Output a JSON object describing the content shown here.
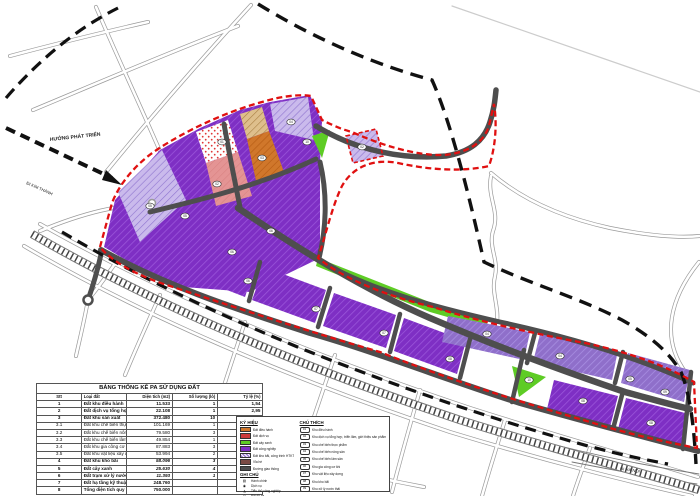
{
  "map": {
    "labels": {
      "development_direction": "HƯỚNG PHÁT TRIỂN",
      "to_kim_thanh": "ĐI KIM THÀNH",
      "to_ha_noi": "ĐI HÀ NỘI"
    },
    "colors": {
      "industrial_purple": "#7e2fc4",
      "industrial_light_purple": "#8f6fca",
      "planned_lavender": "#cabaec",
      "admin_orange": "#d0772b",
      "service_red": "#cc3b3b",
      "green_space": "#5ecc25",
      "pink_zone": "#e49494",
      "tan_zone": "#debf8c",
      "road_dark": "#4e4e4e",
      "railway_gray": "#555555",
      "boundary_red_dashed": "#e01010",
      "boundary_black_dashed": "#111111"
    },
    "parcel_markers": [
      {
        "x": 150,
        "y": 206,
        "l": "05"
      },
      {
        "x": 185,
        "y": 216,
        "l": "05"
      },
      {
        "x": 222,
        "y": 142,
        "l": "01"
      },
      {
        "x": 217,
        "y": 184,
        "l": "02"
      },
      {
        "x": 262,
        "y": 158,
        "l": "03"
      },
      {
        "x": 291,
        "y": 122,
        "l": "04"
      },
      {
        "x": 307,
        "y": 142,
        "l": "10"
      },
      {
        "x": 232,
        "y": 252,
        "l": "06"
      },
      {
        "x": 271,
        "y": 231,
        "l": "06"
      },
      {
        "x": 362,
        "y": 147,
        "l": "02"
      },
      {
        "x": 248,
        "y": 281,
        "l": "06"
      },
      {
        "x": 316,
        "y": 309,
        "l": "07"
      },
      {
        "x": 384,
        "y": 333,
        "l": "07"
      },
      {
        "x": 450,
        "y": 359,
        "l": "08"
      },
      {
        "x": 487,
        "y": 334,
        "l": "04"
      },
      {
        "x": 560,
        "y": 356,
        "l": "04"
      },
      {
        "x": 630,
        "y": 379,
        "l": "05"
      },
      {
        "x": 583,
        "y": 401,
        "l": "08"
      },
      {
        "x": 651,
        "y": 423,
        "l": "08"
      },
      {
        "x": 529,
        "y": 380,
        "l": "10"
      },
      {
        "x": 665,
        "y": 392,
        "l": "09"
      }
    ]
  },
  "table": {
    "title": "BẢNG THỐNG KÊ PA SỬ DỤNG ĐẤT",
    "headers": {
      "no": "Stt",
      "name": "Loại đất",
      "area": "Diện tích (m2)",
      "lots": "Số lượng (lô)",
      "pct": "Tỷ lệ (%)"
    },
    "rows": [
      {
        "no": "1",
        "name": "Đất khu điều hành",
        "area": "11.533",
        "lots": "1",
        "pct": "1,54",
        "b": true,
        "i": false
      },
      {
        "no": "2",
        "name": "Đất dịch vụ tổng hợp",
        "area": "22.108",
        "lots": "1",
        "pct": "2,95",
        "b": true,
        "i": false
      },
      {
        "no": "3",
        "name": "Đất khu sản xuất",
        "area": "372.480",
        "lots": "10",
        "pct": "49,66",
        "b": true,
        "i": false
      },
      {
        "no": "3.1",
        "name": "Đất khu chế biến thực phẩm",
        "area": "101.169",
        "lots": "1",
        "pct": "13,49",
        "b": false,
        "i": false
      },
      {
        "no": "3.2",
        "name": "Đất khu chế biến nông sản",
        "area": "79.580",
        "lots": "3",
        "pct": "10,61",
        "b": false,
        "i": false
      },
      {
        "no": "3.3",
        "name": "Đất khu chế biến lâm sản",
        "area": "49.854",
        "lots": "1",
        "pct": "6,65",
        "b": false,
        "i": false
      },
      {
        "no": "3.4",
        "name": "Đất khu gia công cơ khí",
        "area": "87.883",
        "lots": "3",
        "pct": "11,72",
        "b": false,
        "i": false
      },
      {
        "no": "3.5",
        "name": "Đất khu vật liệu xây dựng",
        "area": "53.994",
        "lots": "2",
        "pct": "7,20",
        "b": false,
        "i": false
      },
      {
        "no": "4",
        "name": "Đất khu kho bãi",
        "area": "58.096",
        "lots": "3",
        "pct": "7,75",
        "b": true,
        "i": true
      },
      {
        "no": "5",
        "name": "Đất cây xanh",
        "area": "25.630",
        "lots": "4",
        "pct": "3,42",
        "b": true,
        "i": true
      },
      {
        "no": "6",
        "name": "Đất trạm xử lý nước thải",
        "area": "11.393",
        "lots": "1",
        "pct": "1,52",
        "b": true,
        "i": true
      },
      {
        "no": "7",
        "name": "Đất hạ tầng kỹ thuật khác",
        "area": "248.760",
        "lots": "",
        "pct": "33,17",
        "b": true,
        "i": false
      },
      {
        "no": "8",
        "name": "Tổng diện tích quy hoạch",
        "area": "750.000",
        "lots": "",
        "pct": "100,00",
        "b": true,
        "i": false
      }
    ]
  },
  "legend": {
    "ky_hieu_title": "KÝ HIỆU",
    "ky_hieu": [
      {
        "color": "#d0772b",
        "hatch": false,
        "label": "Đất điều hành"
      },
      {
        "color": "#cc3b3b",
        "hatch": false,
        "label": "Đất dịch vụ"
      },
      {
        "color": "#5ecc25",
        "hatch": false,
        "label": "Đất cây xanh"
      },
      {
        "color": "#7e2fc4",
        "hatch": false,
        "label": "Đất công nghiệp"
      },
      {
        "color": "#9b7fd4",
        "hatch": true,
        "label": "Đất kho bãi, công trình HTKT"
      },
      {
        "color": "#7a4a44",
        "hatch": false,
        "label": "Vỉa hè"
      },
      {
        "color": "#4e4e4e",
        "hatch": false,
        "label": "Đường giao thông"
      }
    ],
    "ghi_chu_title": "GHI CHÚ",
    "ghi_chu": [
      {
        "sym": "▨",
        "label": "Hành chính"
      },
      {
        "sym": "◉",
        "label": "Dịch vụ"
      },
      {
        "sym": "◮",
        "label": "Tiểu thủ công nghiệp"
      },
      {
        "sym": "⊙",
        "label": "Bãi đỗ xe"
      },
      {
        "sym": "➤",
        "label": "Trạm xử lý nước thải"
      }
    ],
    "chu_thich_title": "CHÚ THÍCH",
    "chu_thich": [
      {
        "no": "01",
        "label": "Khu điều hành"
      },
      {
        "no": "02",
        "label": "Khu dịch vụ tổng hợp, triển lãm, giới thiệu sản phẩm"
      },
      {
        "no": "03",
        "label": "Khu chế biến thực phẩm"
      },
      {
        "no": "04",
        "label": "Khu chế biến nông sản"
      },
      {
        "no": "05",
        "label": "Khu chế biến lâm sản"
      },
      {
        "no": "06",
        "label": "Khu gia công cơ khí"
      },
      {
        "no": "07",
        "label": "Khu vật liệu xây dựng"
      },
      {
        "no": "08",
        "label": "Khu kho bãi"
      },
      {
        "no": "09",
        "label": "Khu xử lý nước thải"
      }
    ]
  }
}
